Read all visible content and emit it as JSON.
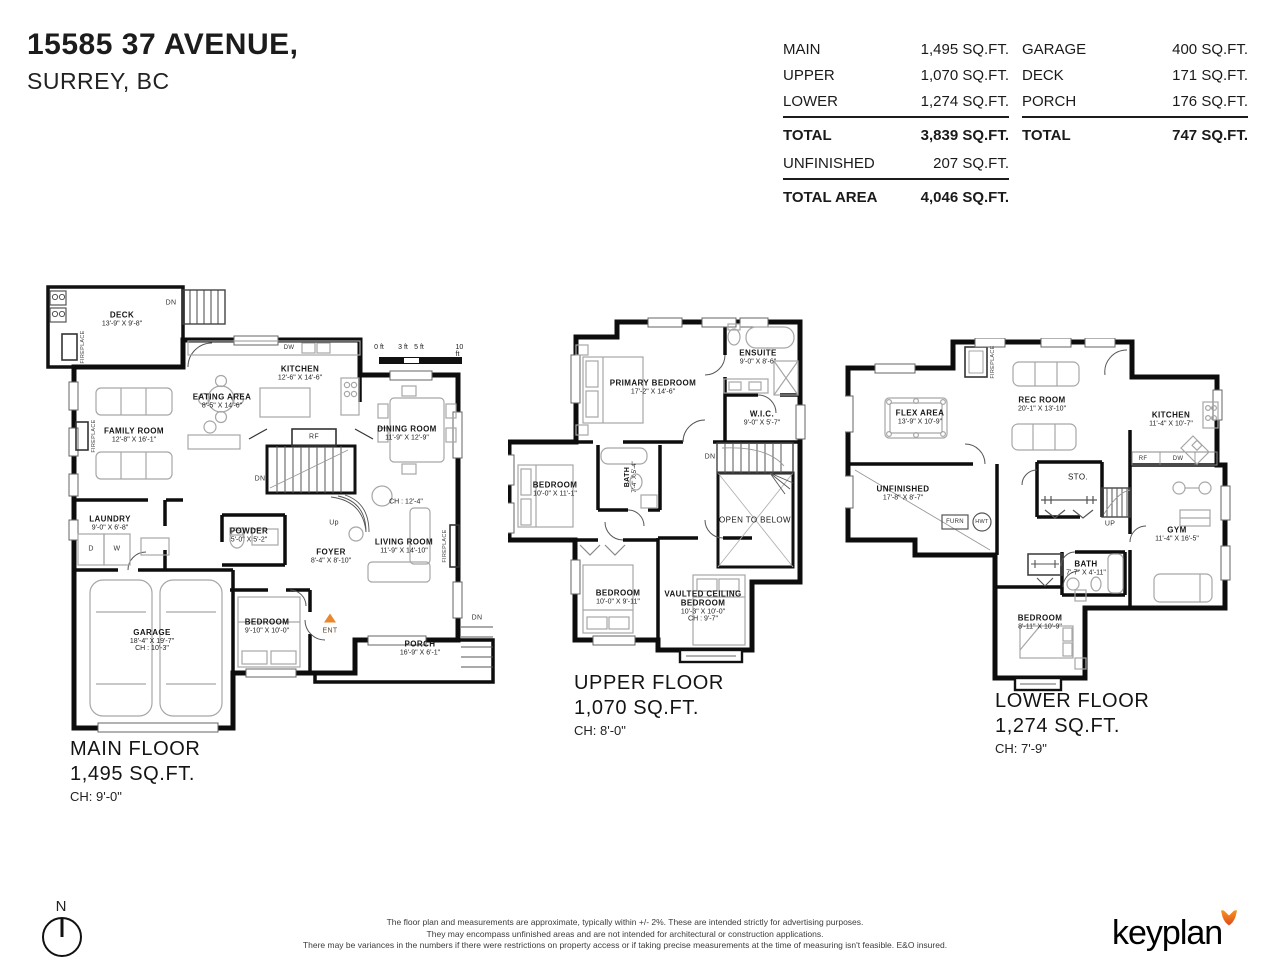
{
  "header": {
    "address_line1": "15585 37 AVENUE,",
    "address_line2": "SURREY, BC"
  },
  "summary": {
    "left": {
      "rows": [
        {
          "label": "MAIN",
          "value": "1,495 SQ.FT."
        },
        {
          "label": "UPPER",
          "value": "1,070 SQ.FT."
        },
        {
          "label": "LOWER",
          "value": "1,274 SQ.FT."
        }
      ],
      "total": {
        "label": "TOTAL",
        "value": "3,839 SQ.FT."
      },
      "unfinished": {
        "label": "UNFINISHED",
        "value": "207 SQ.FT."
      },
      "total_area": {
        "label": "TOTAL AREA",
        "value": "4,046 SQ.FT."
      }
    },
    "right": {
      "rows": [
        {
          "label": "GARAGE",
          "value": "400 SQ.FT."
        },
        {
          "label": "DECK",
          "value": "171 SQ.FT."
        },
        {
          "label": "PORCH",
          "value": "176 SQ.FT."
        }
      ],
      "total": {
        "label": "TOTAL",
        "value": "747 SQ.FT."
      }
    }
  },
  "scale_bar": {
    "labels": [
      "0 ft",
      "3 ft",
      "5 ft",
      "10 ft"
    ]
  },
  "floors": {
    "main": {
      "title": "MAIN FLOOR",
      "area": "1,495 SQ.FT.",
      "ceiling": "CH: 9'-0\"",
      "rooms": {
        "deck": {
          "name": "DECK",
          "dims": "13'-9\" X 9'-8\""
        },
        "kitchen": {
          "name": "KITCHEN",
          "dims": "12'-6\" X 14'-6\""
        },
        "eating": {
          "name": "EATING AREA",
          "dims": "8'-5\" X 14'-6\""
        },
        "family": {
          "name": "FAMILY ROOM",
          "dims": "12'-8\" X 16'-1\""
        },
        "dining": {
          "name": "DINING ROOM",
          "dims": "11'-9\" X 12'-9\"",
          "note": "CH : 12'-4\""
        },
        "laundry": {
          "name": "LAUNDRY",
          "dims": "9'-0\" X 6'-8\""
        },
        "powder": {
          "name": "POWDER",
          "dims": "5'-0\" X 5'-2\""
        },
        "foyer": {
          "name": "FOYER",
          "dims": "8'-4\" X 8'-10\""
        },
        "living": {
          "name": "LIVING ROOM",
          "dims": "11'-9\" X 14'-10\""
        },
        "garage": {
          "name": "GARAGE",
          "dims": "18'-4\" X 19'-7\"",
          "note": "CH : 10'-3\""
        },
        "bedroom": {
          "name": "BEDROOM",
          "dims": "9'-10\" X 10'-0\""
        },
        "porch": {
          "name": "PORCH",
          "dims": "16'-9\" X 6'-1\""
        }
      },
      "labels": {
        "deck_dn": "DN",
        "dw": "DW",
        "rf": "RF",
        "stairs_dn": "DN",
        "stairs_up": "Up",
        "d": "D",
        "w": "W",
        "ent": "ENT",
        "porch_dn": "DN",
        "fireplace1": "FIREPLACE",
        "fireplace2": "FIREPLACE",
        "fireplace3": "FIREPLACE"
      }
    },
    "upper": {
      "title": "UPPER FLOOR",
      "area": "1,070 SQ.FT.",
      "ceiling": "CH: 8'-0\"",
      "rooms": {
        "primary": {
          "name": "PRIMARY BEDROOM",
          "dims": "17'-2\" X 14'-6\""
        },
        "ensuite": {
          "name": "ENSUITE",
          "dims": "9'-0\" X 8'-6\""
        },
        "wic": {
          "name": "W.I.C.",
          "dims": "9'-0\" X 5'-7\""
        },
        "bedroom2": {
          "name": "BEDROOM",
          "dims": "10'-0\" X 11'-1\""
        },
        "bath": {
          "name": "BATH",
          "dims": "7'-4\" X 5'-4\""
        },
        "open_below": {
          "name": "OPEN TO BELOW"
        },
        "bedroom3": {
          "name": "BEDROOM",
          "dims": "10'-0\" X 9'-11\""
        },
        "vaulted": {
          "name": "VAULTED CEILING",
          "name2": "BEDROOM",
          "dims": "10'-3\" X 10'-0\"",
          "note": "CH : 9'-7\""
        }
      },
      "labels": {
        "dn": "DN"
      }
    },
    "lower": {
      "title": "LOWER FLOOR",
      "area": "1,274 SQ.FT.",
      "ceiling": "CH: 7'-9\"",
      "rooms": {
        "flex": {
          "name": "FLEX AREA",
          "dims": "13'-9\" X 10'-9\""
        },
        "rec": {
          "name": "REC ROOM",
          "dims": "20'-1\" X 13'-10\""
        },
        "kitchen": {
          "name": "KITCHEN",
          "dims": "11'-4\" X 10'-7\""
        },
        "unfinished": {
          "name": "UNFINISHED",
          "dims": "17'-8\" X 8'-7\""
        },
        "sto": {
          "name": "STO."
        },
        "gym": {
          "name": "GYM",
          "dims": "11'-4\" X 16'-5\""
        },
        "bath": {
          "name": "BATH",
          "dims": "7'-7\" X 4'-11\""
        },
        "bedroom": {
          "name": "BEDROOM",
          "dims": "8'-11\" X 10'-9\""
        }
      },
      "labels": {
        "furn": "FURN",
        "hwt": "HWT",
        "up": "UP",
        "rf": "RF",
        "dw": "DW",
        "fireplace": "FIREPLACE"
      }
    }
  },
  "footer": {
    "north": "N",
    "disclaimer_line1": "The floor plan and measurements are approximate, typically within +/- 2%. These are intended strictly for advertising purposes.",
    "disclaimer_line2": "They may encompass unfinished areas and are not intended for architectural or construction applications.",
    "disclaimer_line3": "There may be variances in the numbers if there were restrictions on property access or if taking precise measurements at the time of measuring isn't feasible. E&O insured.",
    "logo_text": "keyplan"
  }
}
